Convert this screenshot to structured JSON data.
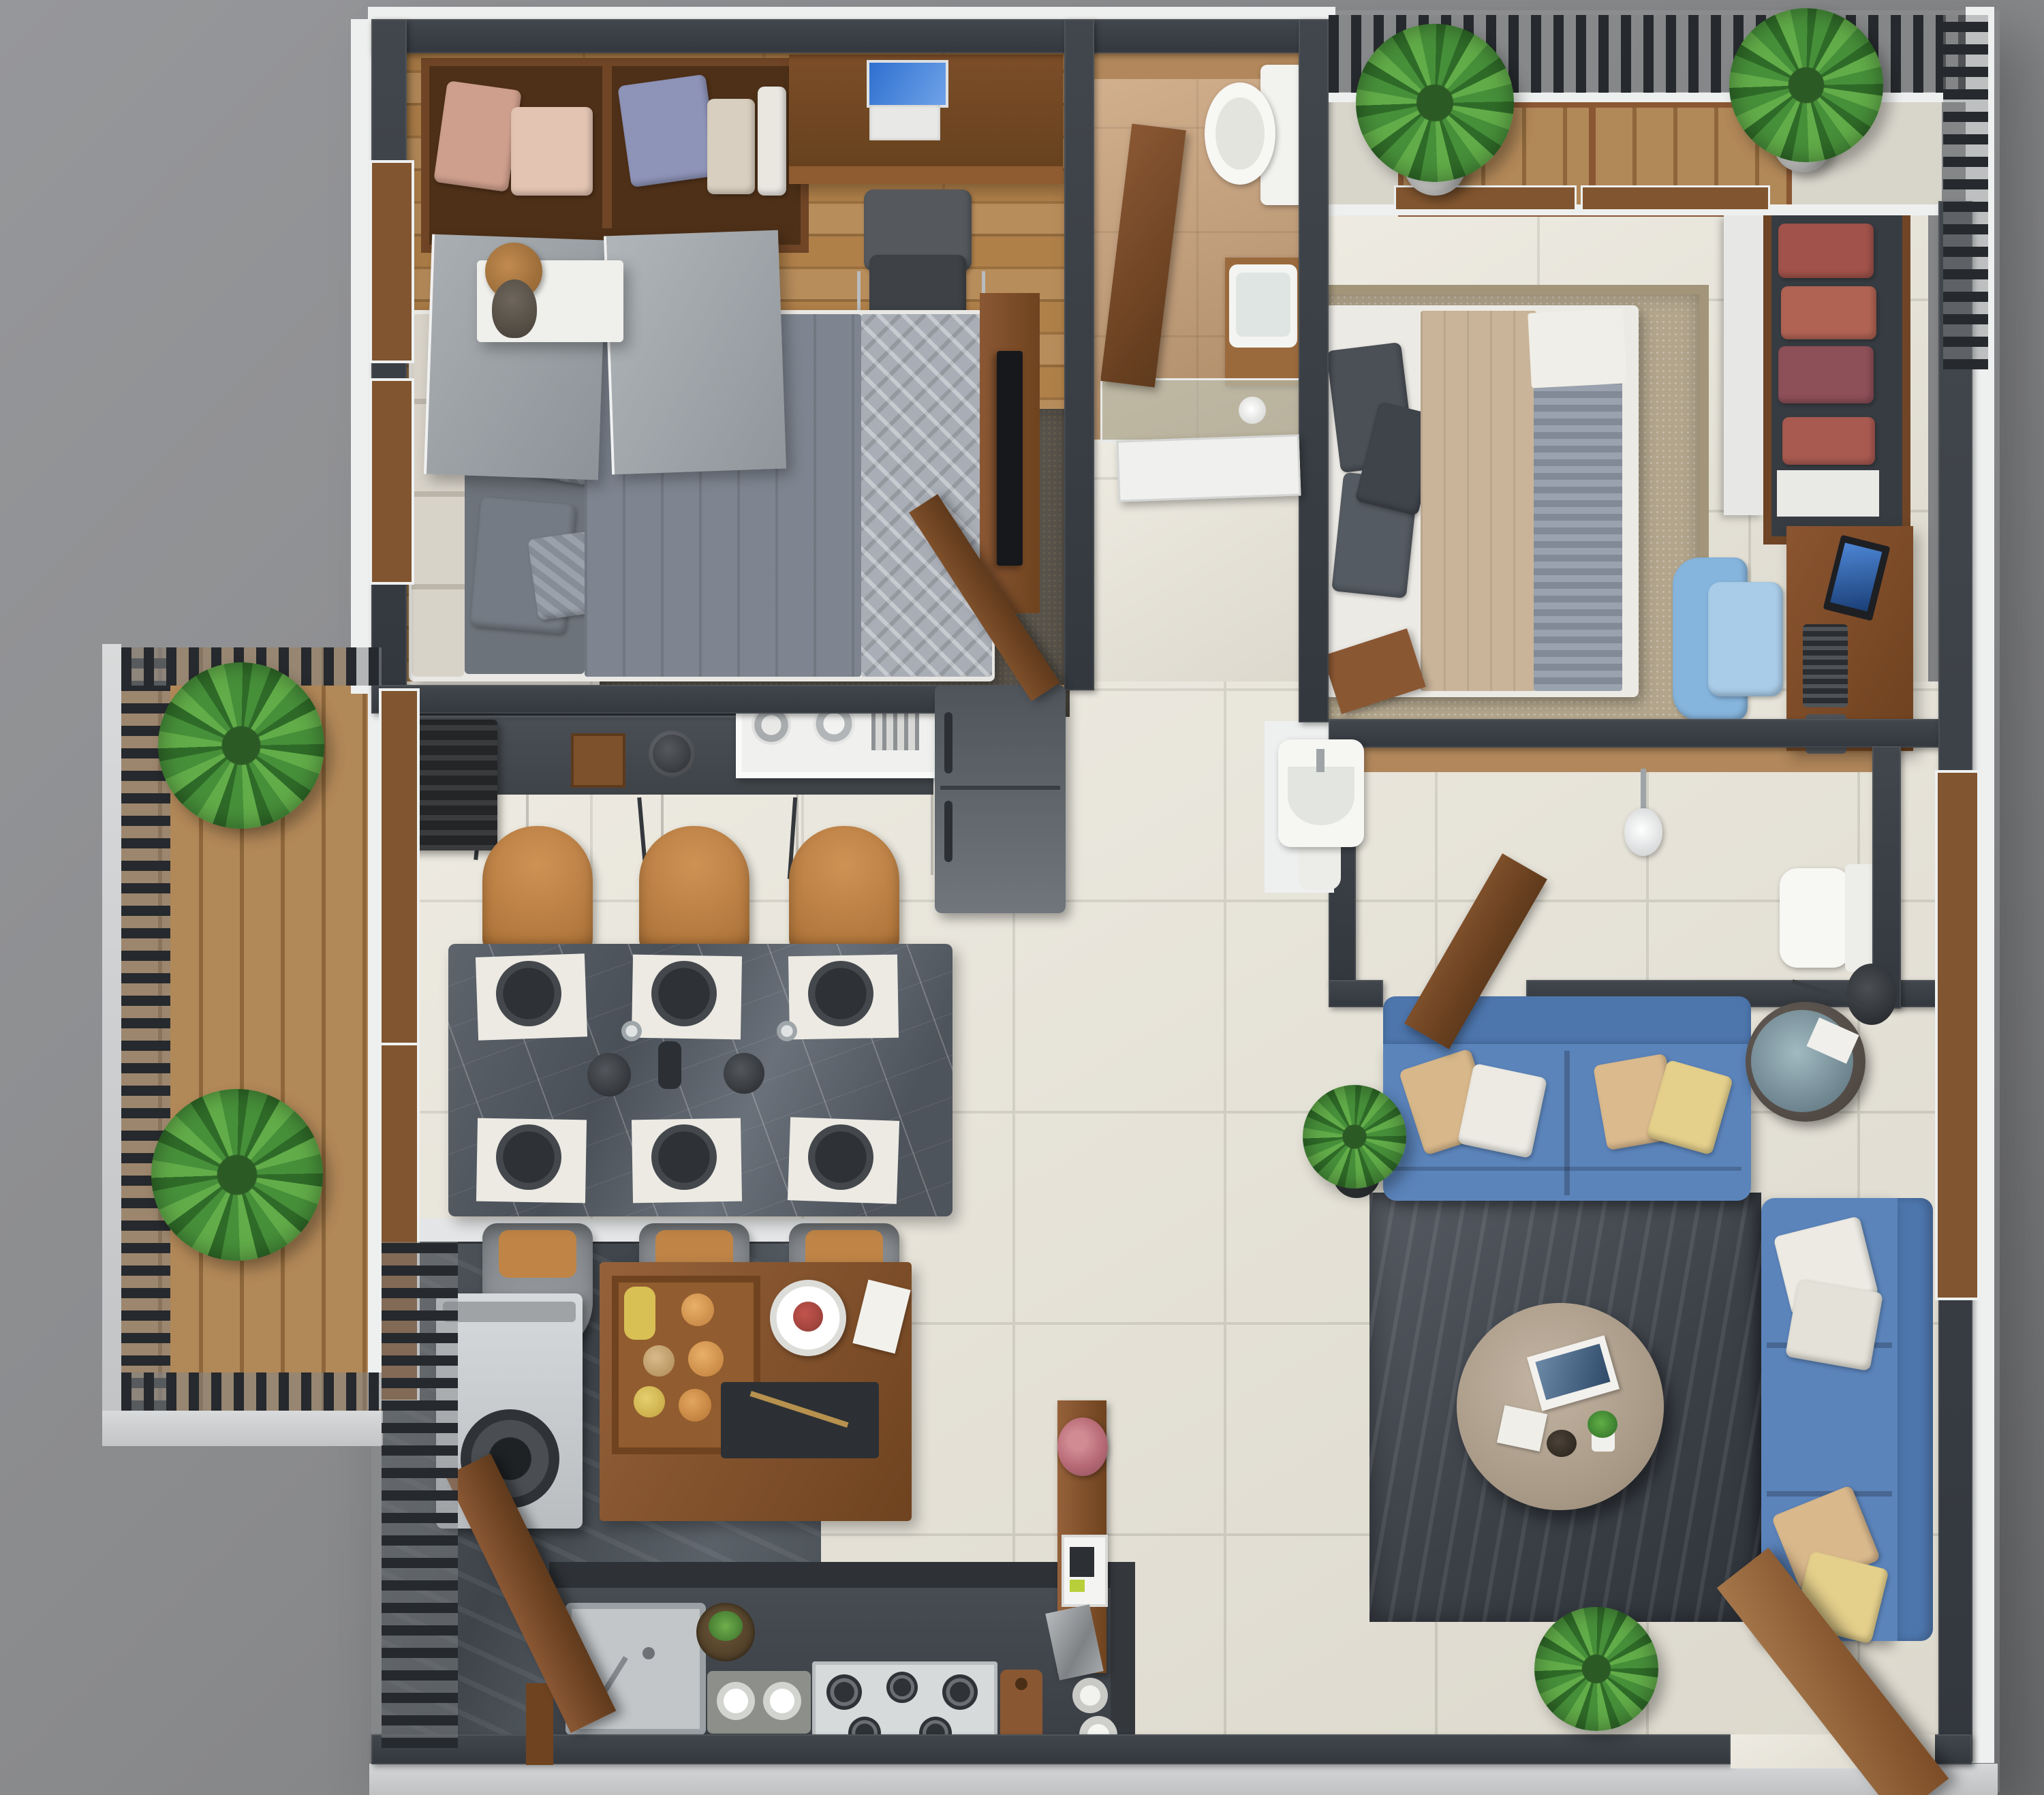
{
  "scene": {
    "type": "3d-floor-plan-render",
    "description": "Top-down isometric 3D render of a furnished two-bedroom apartment with two bathrooms, open kitchen and dining, living room, two balconies and a utility area. No text labels are visible in the image.",
    "no_visible_text": true,
    "background_color": "#8c8d8f"
  },
  "palette": {
    "background_gray": "#8c8d8f",
    "wall_dark": "#383d43",
    "wall_trim_white": "#eef0f0",
    "exterior_face_gray": "#c6c8ca",
    "wood_floor": "#b08049",
    "deck_wood": "#a87a45",
    "door_wood": "#7e4f2a",
    "furniture_wood": "#8a5733",
    "tile_cream": "#e8e4d8",
    "tile_grout": "#cfccbf",
    "bathroom_tile_tan": "#caa178",
    "slate_floor": "#4a5056",
    "counter_dark": "#43484d",
    "cabinet_gray": "#9ba1a6",
    "appliance_black": "#232527",
    "refrigerator_gray": "#61676c",
    "marble_table_gray": "#575c63",
    "placemat_white": "#eceae3",
    "plate_dark": "#34373c",
    "dining_chair_tan": "#bf8446",
    "dining_chair_gray": "#8f9397",
    "sofa_blue": "#5b83ba",
    "rug_charcoal": "#4e535b",
    "rug_beige": "#b2a58c",
    "coffee_table_taupe": "#b7a795",
    "towel_red": "#a1524a",
    "desk_chair_blue": "#85b4dc",
    "plant_green": "#47903a",
    "fixture_white": "#f7f7f5",
    "laptop_screen_blue": "#3f7fd6",
    "blanket_tan": "#c9b499",
    "striped_sheet_gray": "#99a2ae",
    "pillow_dark_gray": "#4b5057",
    "glass_teal": "#c3d4ca",
    "washer_silver": "#ccd0d3"
  },
  "rooms": [
    {
      "name": "master-bedroom",
      "floor": "wood planks",
      "furniture": [
        "open-wardrobe with folded clothes",
        "two gray sliding wardrobe doors",
        "study-desk",
        "laptop",
        "office-chair",
        "double-bed with gray duvet",
        "headboard-cushions",
        "gray-pillows",
        "quilted-runner",
        "nightstand",
        "wooden-table-lamp",
        "dark-area-rug",
        "tv-wall-panel with tv",
        "wooden-entry-door",
        "exterior-windows"
      ]
    },
    {
      "name": "bathroom-1",
      "floor": "tan tile",
      "furniture": [
        "toilet",
        "square-washbasin on wooden vanity",
        "wooden-partition",
        "glass-shower-screen",
        "toilet-paper-roll",
        "open-white-door"
      ]
    },
    {
      "name": "bedroom-2-balcony",
      "floor": "wood deck tiles",
      "furniture": [
        "slat-railing",
        "potted-palm",
        "potted-palm",
        "window-sill-frames"
      ]
    },
    {
      "name": "bedroom-2",
      "floor": "cream tile",
      "furniture": [
        "double-bed with tan blanket and striped sheet",
        "dark-gray-pillows",
        "beige-area-rug",
        "open-shelf-wardrobe with red towels",
        "computer-desk",
        "monitor",
        "keyboard",
        "mouse-pad",
        "blue-office-chair",
        "wooden-footboard"
      ]
    },
    {
      "name": "bathroom-2",
      "floor": "tan tile",
      "furniture": [
        "shower-head",
        "toilet",
        "wooden-door",
        "external-washbasin"
      ]
    },
    {
      "name": "kitchen",
      "floor": "cream tile",
      "furniture": [
        "backsplash-wall",
        "dark-countertop",
        "microwave",
        "coffee-box",
        "kettle",
        "dish-shelf with plates",
        "gray-cabinet-front with handles",
        "refrigerator"
      ]
    },
    {
      "name": "dining-area",
      "floor": "cream tile",
      "furniture": [
        "marble-dining-table",
        "six-placemats",
        "six-dark-plates",
        "serving-bowls",
        "glasses",
        "three-tan-chairs-top",
        "three-tan-chairs-bottom"
      ]
    },
    {
      "name": "living-room",
      "floor": "cream tile",
      "furniture": [
        "blue-sofa-horizontal",
        "blue-sofa-vertical",
        "throw-pillows",
        "drum-side-table with glass top",
        "floor-lamp",
        "charcoal-rug",
        "round-coffee-table",
        "magazine",
        "mini-plant",
        "decor-items",
        "potted-plant",
        "potted-plant",
        "open-wooden-entrance-door"
      ]
    },
    {
      "name": "hallway",
      "floor": "cream tile",
      "furniture": [
        "console-table",
        "flower-bunch",
        "photo-frame",
        "stone-decor",
        "decor-rolls"
      ]
    },
    {
      "name": "utility-balcony",
      "floor": "slate tile",
      "furniture": [
        "slat-railing",
        "washing-machine",
        "wooden-door",
        "island-counter",
        "fruit-crate",
        "serving-plate",
        "napkin",
        "utensil-tray"
      ]
    },
    {
      "name": "kitchen-back-counter",
      "floor": "slate/cream",
      "furniture": [
        "steel-sink",
        "herbs-bowl",
        "jar-board",
        "gas-hob-5-burner",
        "cutting-board"
      ]
    },
    {
      "name": "side-balcony",
      "floor": "wood deck",
      "furniture": [
        "slat-railing",
        "potted-palm",
        "potted-palm",
        "glass-doors-wood-frame"
      ]
    }
  ]
}
